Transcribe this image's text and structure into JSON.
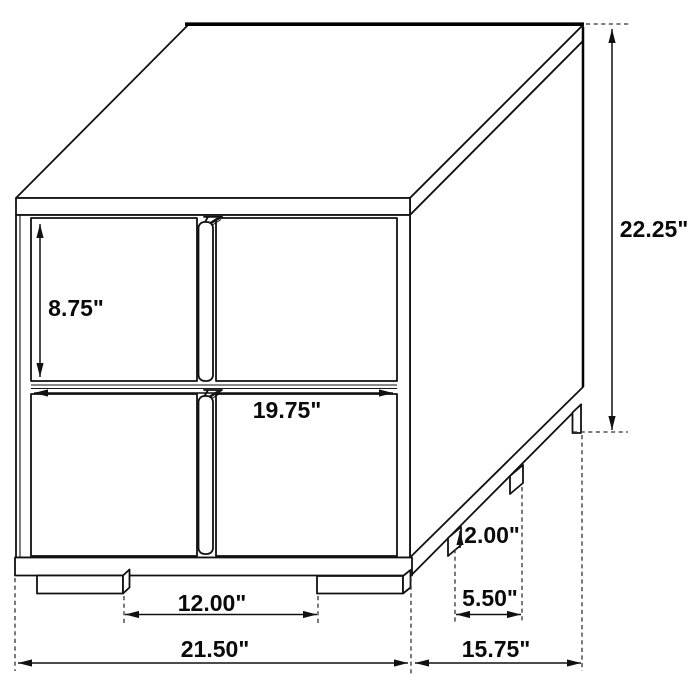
{
  "diagram": {
    "title": "Two-drawer nightstand isometric dimension drawing",
    "background": "#ffffff",
    "line_color": "#111111",
    "labels": {
      "overall_height": "22.25\"",
      "drawer_height": "8.75\"",
      "drawer_front_width": "19.75\"",
      "leg_height": "2.00\"",
      "side_leg_spacing": "5.50\"",
      "front_leg_spacing": "12.00\"",
      "overall_width": "21.50\"",
      "overall_depth": "15.75\""
    }
  }
}
